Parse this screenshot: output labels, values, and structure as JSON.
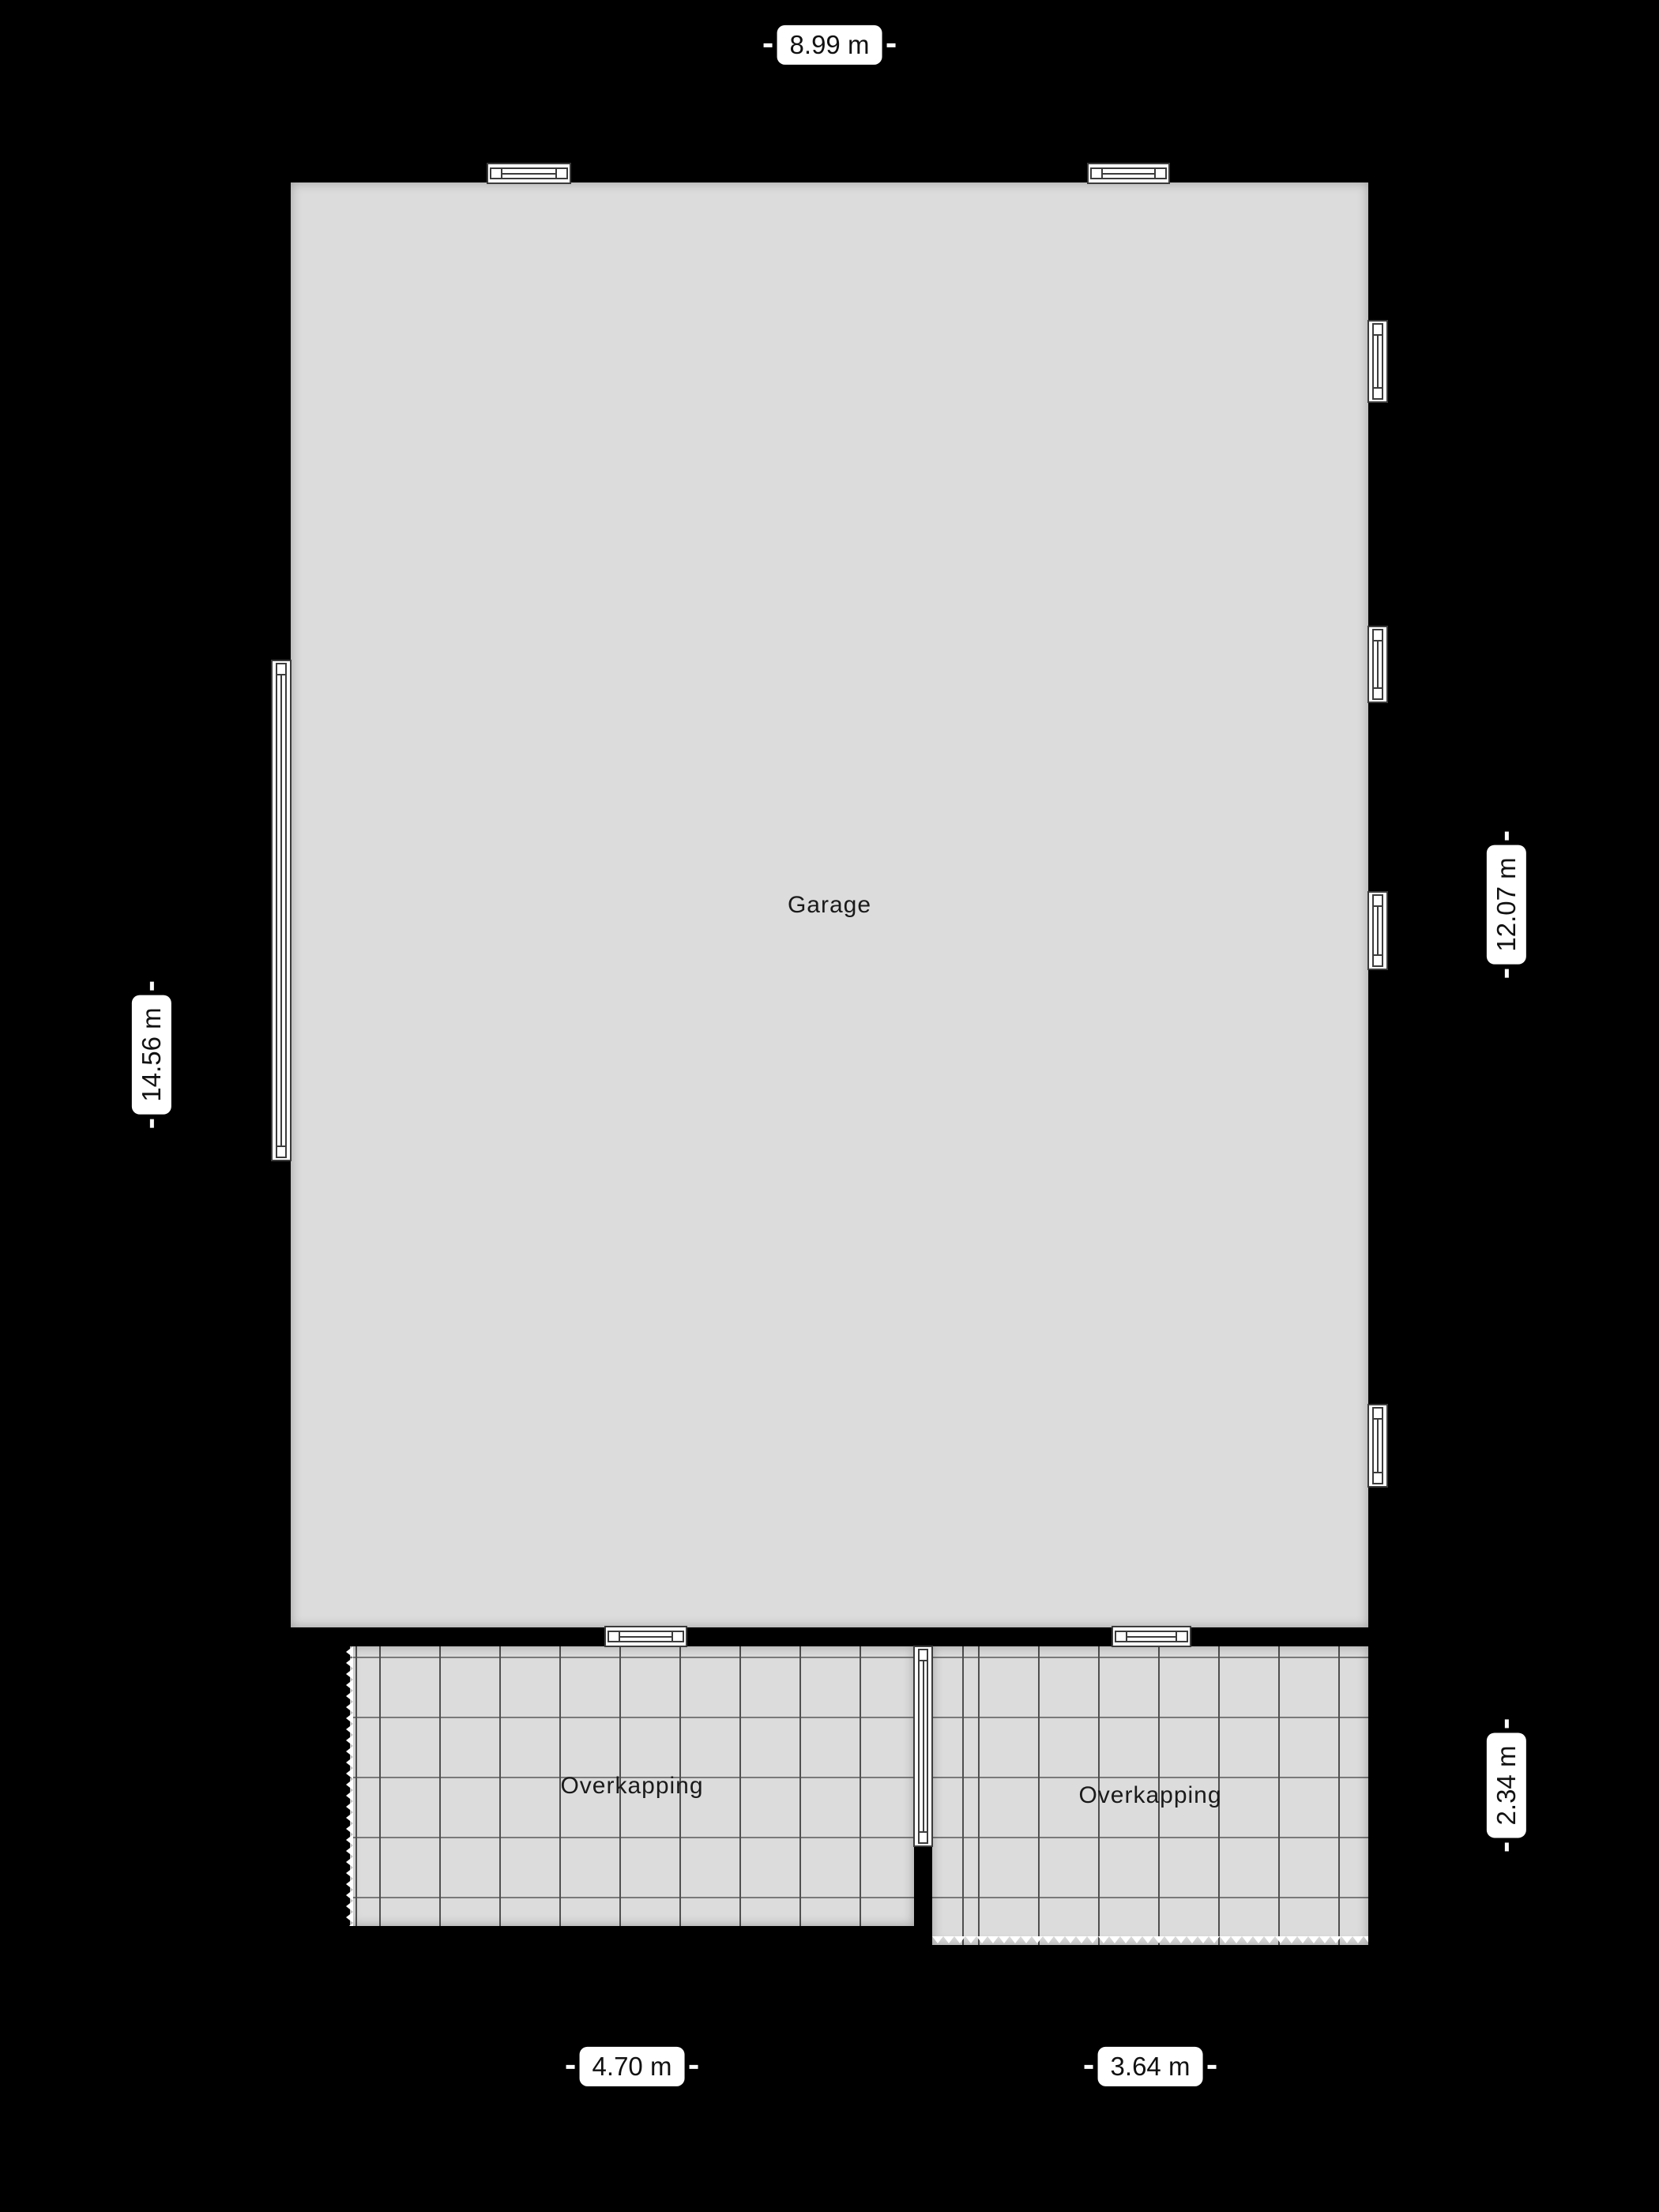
{
  "floorplan": {
    "rooms": {
      "garage": {
        "label": "Garage"
      },
      "overkapping_left": {
        "label": "Overkapping"
      },
      "overkapping_right": {
        "label": "Overkapping"
      }
    },
    "dimensions": {
      "top": "8.99 m",
      "left": "14.56 m",
      "right_upper": "12.07 m",
      "right_lower": "2.34 m",
      "bottom_left": "4.70 m",
      "bottom_right": "3.64 m"
    },
    "colors": {
      "background": "#000000",
      "room_fill": "#dcdcdc",
      "grid_line": "#4f4f4f",
      "wall": "#000000",
      "window_frame": "#3c3c3c",
      "label_background": "#ffffff",
      "label_text": "#111111"
    }
  }
}
